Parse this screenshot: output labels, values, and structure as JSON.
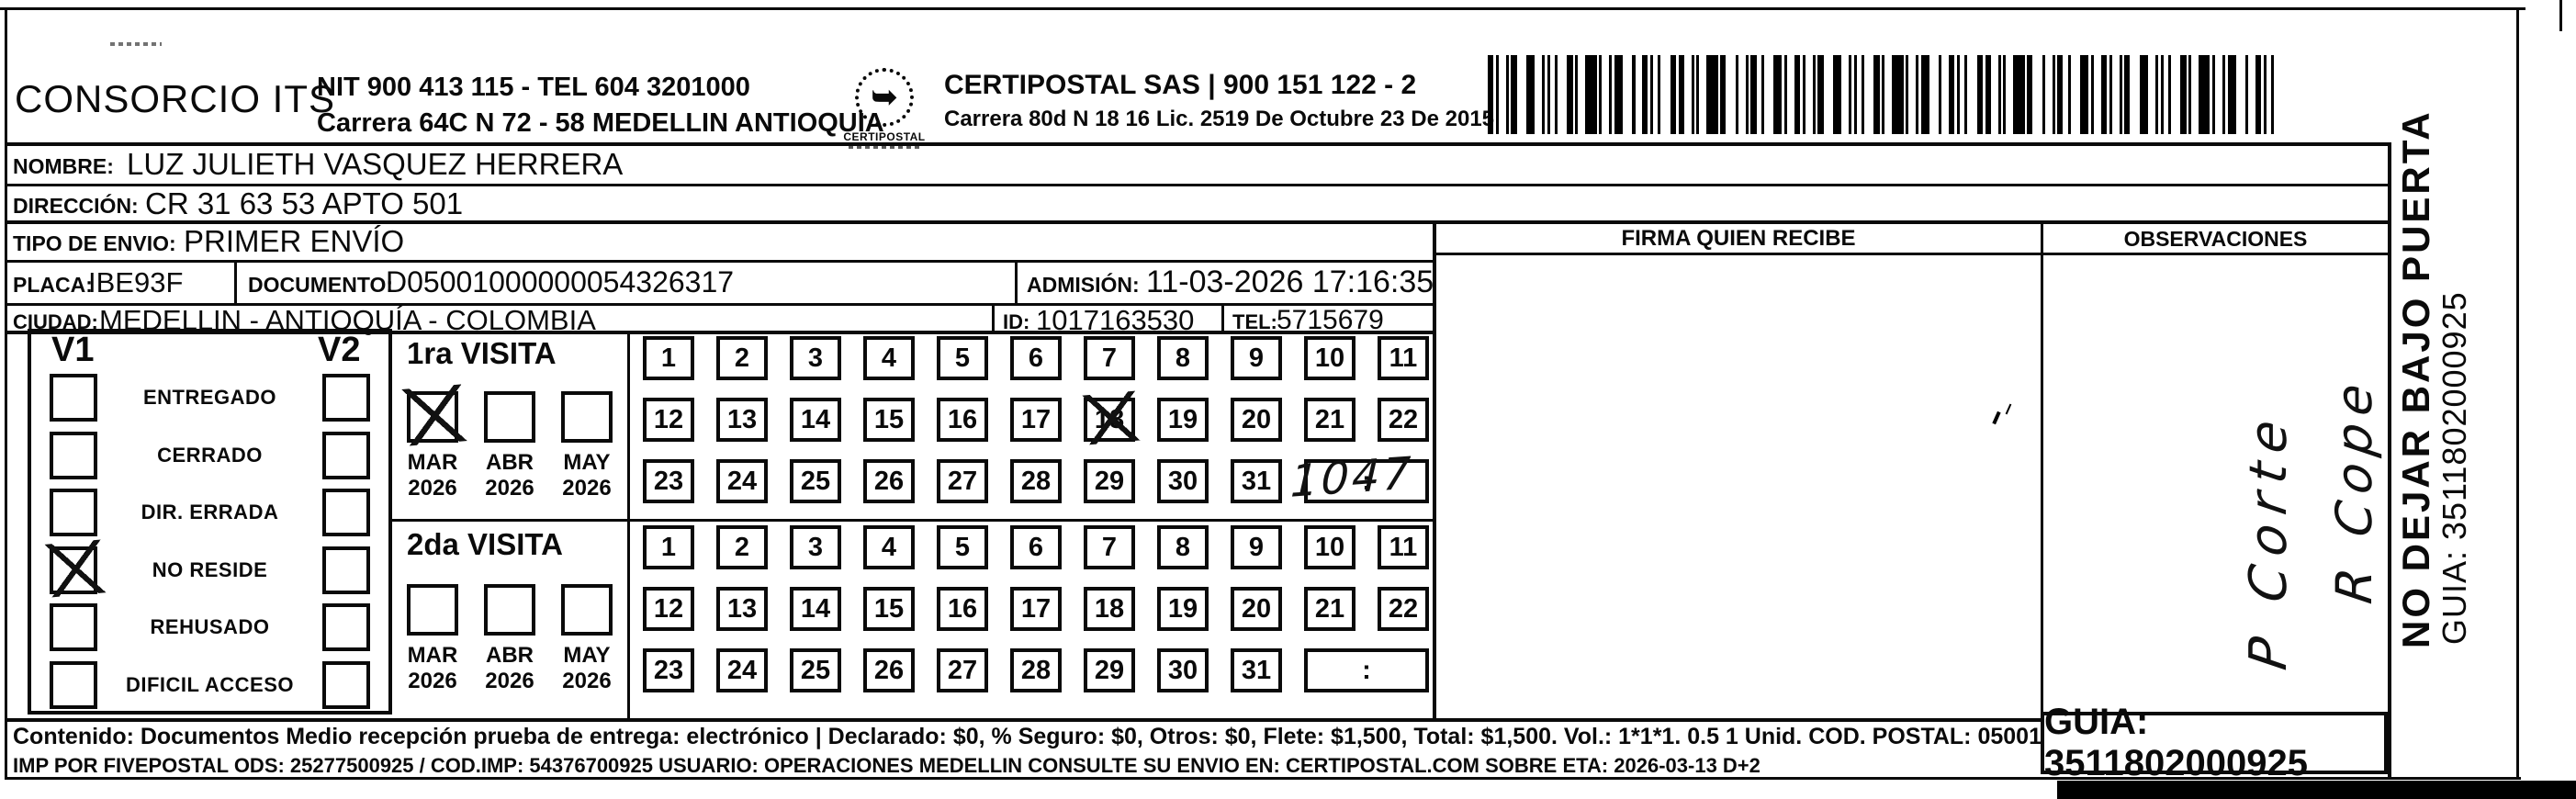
{
  "header": {
    "company_name": "CONSORCIO ITS",
    "nit_line": "NIT 900 413 115 - TEL 604 3201000",
    "address_line": "Carrera 64C N 72 - 58 MEDELLIN ANTIOQUIA",
    "logo_text": "CERTIPOSTAL",
    "logo_glyph": "➥",
    "partner_line1": "CERTIPOSTAL SAS | 900 151 122 - 2",
    "partner_line2": "Carrera 80d N 18 16  Lic. 2519 De Octubre 23 De 2015"
  },
  "shipment": {
    "nombre_label": "NOMBRE:",
    "nombre": "LUZ JULIETH VASQUEZ HERRERA",
    "direccion_label": "DIRECCIÓN:",
    "direccion": "CR 31 63 53 APTO 501",
    "tipo_envio_label": "TIPO DE ENVIO:",
    "tipo_envio": "PRIMER ENVÍO",
    "placa_label": "PLACA:",
    "placa": "IBE93F",
    "documento_label": "DOCUMENTO:",
    "documento": "D05001000000054326317",
    "admision_label": "ADMISIÓN:",
    "admision": "11-03-2026 17:16:35",
    "ciudad_label": "CIUDAD:",
    "ciudad": "MEDELLIN - ANTIOQUÍA - COLOMBIA",
    "id_label": "ID:",
    "id_value": "1017163530",
    "tel_label": "TEL:",
    "tel": "5715679"
  },
  "columns": {
    "firma": "FIRMA QUIEN RECIBE",
    "observaciones": "OBSERVACIONES"
  },
  "status_panel": {
    "v1_label": "V1",
    "v2_label": "V2",
    "options": [
      {
        "label": "ENTREGADO",
        "v1": false,
        "v2": false
      },
      {
        "label": "CERRADO",
        "v1": false,
        "v2": false
      },
      {
        "label": "DIR. ERRADA",
        "v1": false,
        "v2": false
      },
      {
        "label": "NO RESIDE",
        "v1": true,
        "v2": false
      },
      {
        "label": "REHUSADO",
        "v1": false,
        "v2": false
      },
      {
        "label": "DIFICIL ACCESO",
        "v1": false,
        "v2": false
      }
    ]
  },
  "visit1": {
    "title": "1ra VISITA",
    "months": [
      {
        "m": "MAR",
        "y": "2026",
        "checked": true
      },
      {
        "m": "ABR",
        "y": "2026",
        "checked": false
      },
      {
        "m": "MAY",
        "y": "2026",
        "checked": false
      }
    ],
    "days": [
      1,
      2,
      3,
      4,
      5,
      6,
      7,
      8,
      9,
      10,
      11,
      12,
      13,
      14,
      15,
      16,
      17,
      18,
      19,
      20,
      21,
      22,
      23,
      24,
      25,
      26,
      27,
      28,
      29,
      30,
      31
    ],
    "crossed_day": 18,
    "time_separator": ":",
    "handwritten_time": "1047"
  },
  "visit2": {
    "title": "2da VISITA",
    "months": [
      {
        "m": "MAR",
        "y": "2026",
        "checked": false
      },
      {
        "m": "ABR",
        "y": "2026",
        "checked": false
      },
      {
        "m": "MAY",
        "y": "2026",
        "checked": false
      }
    ],
    "days": [
      1,
      2,
      3,
      4,
      5,
      6,
      7,
      8,
      9,
      10,
      11,
      12,
      13,
      14,
      15,
      16,
      17,
      18,
      19,
      20,
      21,
      22,
      23,
      24,
      25,
      26,
      27,
      28,
      29,
      30,
      31
    ],
    "time_separator": ":"
  },
  "footer": {
    "line1": "Contenido: Documentos Medio recepción prueba de entrega: electrónico | Declarado: $0, % Seguro: $0, Otros: $0, Flete: $1,500, Total: $1,500. Vol.: 1*1*1. 0.5  1 Unid. COD. POSTAL: 050013",
    "line2": "IMP POR FIVEPOSTAL ODS: 25277500925 / COD.IMP: 54376700925 USUARIO: OPERACIONES MEDELLIN CONSULTE SU ENVIO EN: CERTIPOSTAL.COM SOBRE ETA: 2026-03-13 D+2",
    "guia_box": "GUIA: 3511802000925"
  },
  "side_margin": {
    "warning": "NO DEJAR BAJO PUERTA",
    "guia": "GUIA: 3511802000925"
  },
  "handwriting": {
    "observaciones_line1": "P Corte",
    "observaciones_line2": "R Cope"
  }
}
